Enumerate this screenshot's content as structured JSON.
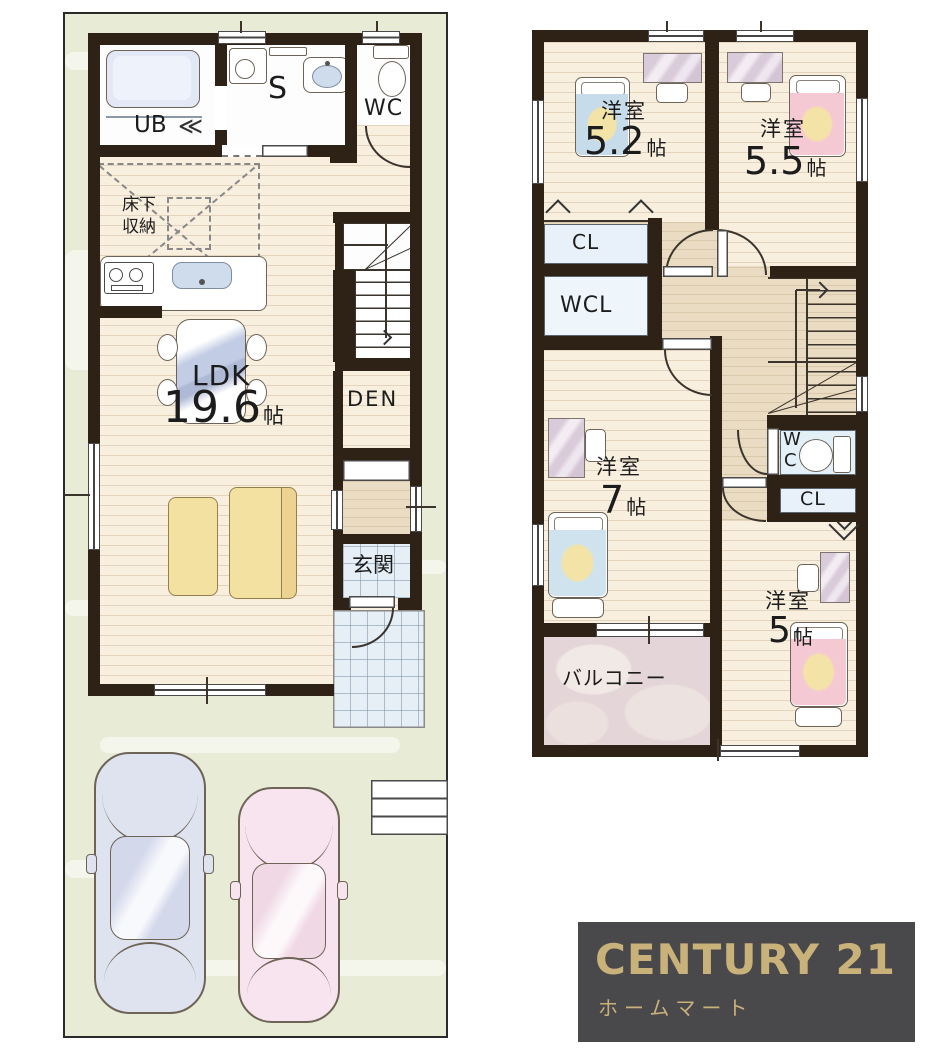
{
  "colors": {
    "wall": "#2e2217",
    "site_green": "#e8ecd7",
    "floor_cream": "#f9efdf",
    "hall_tan": "#eadcc2",
    "tile_blue": "#e6eef6",
    "closet_blue": "#e8f1f9",
    "balcony_mauve": "#e4d5d8",
    "bed_blue": "#c7dcea",
    "bed_pink": "#f5c9d4",
    "accent_yellow": "#f3e3a6",
    "sofa_yellow": "#f3e1a2",
    "logo_bg": "#49484a",
    "logo_gold": "#c9b17a"
  },
  "icons": {
    "folding_door": "≪"
  },
  "floor1": {
    "bath": "UB",
    "sanitary": "S",
    "toilet": "WC",
    "underfloor_storage_line1": "床下",
    "underfloor_storage_line2": "収納",
    "ldk_name": "LDK",
    "ldk_size": "19.6",
    "ldk_unit": "帖",
    "den": "DEN",
    "entrance": "玄関"
  },
  "floor2": {
    "bedroom_a": "洋室",
    "bedroom_a_size": "5.2",
    "bedroom_a_unit": "帖",
    "bedroom_b": "洋室",
    "bedroom_b_size": "5.5",
    "bedroom_b_unit": "帖",
    "closet_a": "CL",
    "walk_in_closet": "WCL",
    "bedroom_c": "洋室",
    "bedroom_c_size": "7",
    "bedroom_c_unit": "帖",
    "toilet_line1": "W",
    "toilet_line2": "C",
    "closet_b": "CL",
    "bedroom_d": "洋室",
    "bedroom_d_size": "5",
    "bedroom_d_unit": "帖",
    "balcony": "バルコニー"
  },
  "logo": {
    "brand": "CENTURY 21",
    "company": "ホームマート"
  }
}
